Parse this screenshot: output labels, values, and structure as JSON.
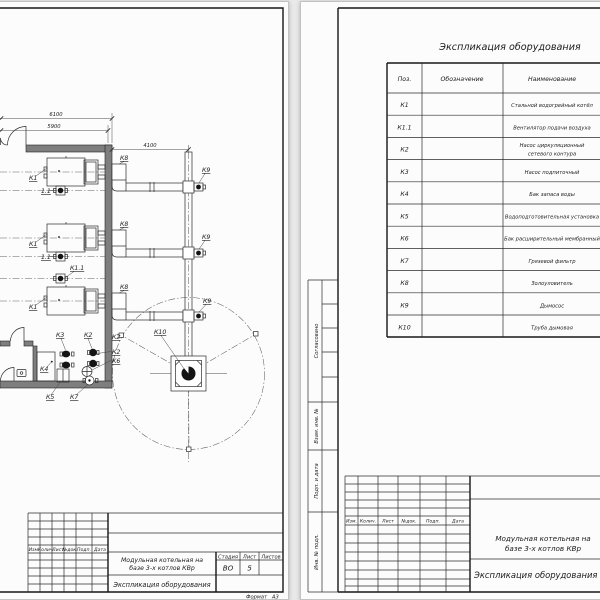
{
  "colors": {
    "paper": "#fcfcfc",
    "background": "#e9e9e9",
    "line": "#2b2b2b"
  },
  "left_sheet": {
    "drawing": {
      "dimensions": {
        "overall_width": "6100",
        "inner_width": "5900",
        "flue_offset": "4100"
      },
      "labels": {
        "boiler": "К1",
        "boiler_fan": "1.1",
        "boiler_fan_full": "К1.1",
        "ash_collector": "К8",
        "smoke_exhauster": "К9",
        "chimney": "К10",
        "circulation_pump": "К2",
        "feed_pump": "К3",
        "water_tank": "К4",
        "water_treatment": "К5",
        "expansion_tank": "К6",
        "dirt_filter": "К7"
      }
    },
    "title_block": {
      "rev_headers": [
        "Изм.",
        "Колич.",
        "Лист",
        "№док.",
        "Подп.",
        "Дата"
      ],
      "project_line1": "Модульная котельная на",
      "project_line2": "базе 3-х котлов КВр",
      "stage_label": "Стадия",
      "sheet_label": "Лист",
      "sheets_label": "Листов",
      "stage_value": "ВО",
      "sheet_value": "5",
      "doc_title": "Экспликация оборудования",
      "format_label": "Формат",
      "format_value": "А3"
    }
  },
  "right_sheet": {
    "table_title": "Экспликация оборудования",
    "table_headers": [
      "Поз.",
      "Обозначение",
      "Наименование"
    ],
    "rows": [
      {
        "pos": "К1",
        "name": "Стальной водогрейный котёл"
      },
      {
        "pos": "К1.1",
        "name": "Вентилятор подачи воздуха"
      },
      {
        "pos": "К2",
        "name": "Насос циркуляционный сетевого контура",
        "name_line1": "Насос циркуляционный",
        "name_line2": "сетевого контура"
      },
      {
        "pos": "К3",
        "name": "Насос подпиточный"
      },
      {
        "pos": "К4",
        "name": "Бак запаса воды"
      },
      {
        "pos": "К5",
        "name": "Водоподготовительная установка"
      },
      {
        "pos": "К6",
        "name": "Бак расширительный мембранный"
      },
      {
        "pos": "К7",
        "name": "Грязевой фильтр"
      },
      {
        "pos": "К8",
        "name": "Золоуловитель"
      },
      {
        "pos": "К9",
        "name": "Дымосос"
      },
      {
        "pos": "К10",
        "name": "Труба дымовая"
      }
    ],
    "margin_labels": {
      "approved": "Согласовано",
      "replace_inv": "Взам. инв. №",
      "sign_date": "Подп. и дата",
      "inv_original": "Инв. № подл."
    },
    "title_block": {
      "rev_headers": [
        "Изм.",
        "Колич.",
        "Лист",
        "№док.",
        "Подп.",
        "Дата"
      ],
      "project_line1": "Модульная котельная на",
      "project_line2": "базе 3-х котлов КВр",
      "doc_title": "Экспликация оборудования"
    }
  }
}
